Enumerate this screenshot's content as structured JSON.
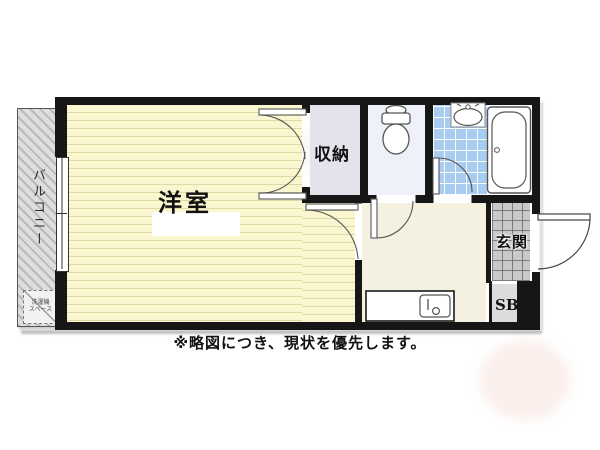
{
  "floor_plan": {
    "rooms": {
      "balcony": "バルコニー",
      "washer_space_line1": "洗濯機",
      "washer_space_line2": "スペース",
      "western_room": "洋室",
      "closet": "収納",
      "entrance": "玄関",
      "shoe_box": "SB"
    },
    "fixtures": [
      "toilet-icon",
      "washbasin-icon",
      "bathtub-icon",
      "kitchen-sink-icon",
      "door-swing-arc"
    ],
    "colors": {
      "wall": "#161616",
      "western_room_floor": "#faf6cf",
      "kitchen_floor": "#f4f1e1",
      "closet_floor": "#e4e2ea",
      "toilet_floor": "#eef1f8",
      "bath_tile": "#a9cdf0",
      "entrance_tile": "#c9c9c9",
      "balcony": "#d8d8d8"
    }
  },
  "footer": {
    "disclaimer": "※略図につき、現状を優先します。"
  }
}
